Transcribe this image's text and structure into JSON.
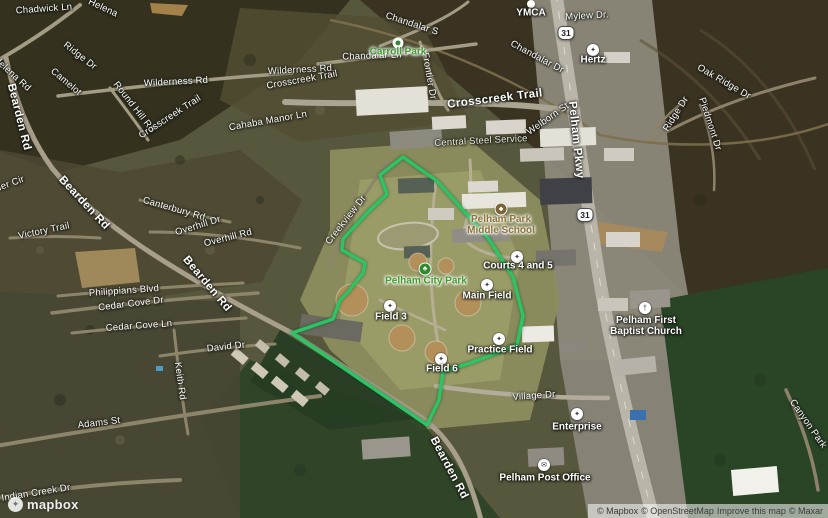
{
  "map": {
    "description": "3D satellite map of Pelham, Alabama with Pelham City Park boundary highlighted",
    "boundary": {
      "color": "#2BC565",
      "points": "403,157 437,181 488,238 513,277 523,316 517,345 473,362 443,372 439,400 427,425 292,333 333,319 340,300 348,292 363,273 365,263 342,250 343,239 368,212 387,194 380,175"
    }
  },
  "shields": [
    {
      "label": "31",
      "x": 566,
      "y": 33
    },
    {
      "label": "31",
      "x": 585,
      "y": 215
    }
  ],
  "road_labels": [
    {
      "t": "Chadwick Ln",
      "x": 44,
      "y": 9,
      "r": -4
    },
    {
      "t": "Helena",
      "x": 103,
      "y": 8,
      "r": 25
    },
    {
      "t": "Ridge Dr",
      "x": 80,
      "y": 56,
      "r": 38
    },
    {
      "t": "Helena Rd",
      "x": 12,
      "y": 74,
      "r": 42
    },
    {
      "t": "Camelot",
      "x": 66,
      "y": 82,
      "r": 40
    },
    {
      "t": "Bearden Rd",
      "x": 19,
      "y": 117,
      "r": 76,
      "big": true
    },
    {
      "t": "Wilderness Rd",
      "x": 176,
      "y": 82,
      "r": -3
    },
    {
      "t": "Wilderness Rd",
      "x": 300,
      "y": 70,
      "r": -3
    },
    {
      "t": "Round Hill Rd",
      "x": 134,
      "y": 107,
      "r": 52
    },
    {
      "t": "Crosscreek Trail",
      "x": 170,
      "y": 117,
      "r": -33
    },
    {
      "t": "Crosscreek Trail",
      "x": 302,
      "y": 80,
      "r": -10
    },
    {
      "t": "Cahaba Manor Ln",
      "x": 268,
      "y": 121,
      "r": -10
    },
    {
      "t": "Chandalar Ln",
      "x": 372,
      "y": 56,
      "r": -2
    },
    {
      "t": "Chandalar S",
      "x": 412,
      "y": 24,
      "r": 18
    },
    {
      "t": "Frontier Dr",
      "x": 429,
      "y": 76,
      "r": 80
    },
    {
      "t": "Crosscreek Trail",
      "x": 495,
      "y": 99,
      "r": -7,
      "big": true
    },
    {
      "t": "Welborn St",
      "x": 548,
      "y": 119,
      "r": -35
    },
    {
      "t": "Chandalar Dr",
      "x": 537,
      "y": 57,
      "r": 28
    },
    {
      "t": "Central Steel Service",
      "x": 481,
      "y": 141,
      "r": -3,
      "dim": true
    },
    {
      "t": "Mylew Dr.",
      "x": 587,
      "y": 16,
      "r": -3
    },
    {
      "t": "Oak Ridge Dr",
      "x": 724,
      "y": 82,
      "r": 30
    },
    {
      "t": "Ridge Dr",
      "x": 676,
      "y": 114,
      "r": -58
    },
    {
      "t": "Piedmont Dr",
      "x": 710,
      "y": 124,
      "r": 72
    },
    {
      "t": "Pelham Pkwy",
      "x": 576,
      "y": 140,
      "r": 84,
      "big": true
    },
    {
      "t": "Canterbury Rd",
      "x": 174,
      "y": 209,
      "r": 16
    },
    {
      "t": "Overhill Dr",
      "x": 198,
      "y": 226,
      "r": -17
    },
    {
      "t": "Overhill Rd",
      "x": 228,
      "y": 238,
      "r": -14
    },
    {
      "t": "Creekview Dr",
      "x": 346,
      "y": 220,
      "r": -52
    },
    {
      "t": "Victory Trail",
      "x": 44,
      "y": 231,
      "r": -12
    },
    {
      "t": "her Cir",
      "x": 10,
      "y": 184,
      "r": -20
    },
    {
      "t": "Bearden Rd",
      "x": 84,
      "y": 203,
      "r": 47,
      "big": true
    },
    {
      "t": "Bearden Rd",
      "x": 207,
      "y": 284,
      "r": 50,
      "big": true
    },
    {
      "t": "Bearden Rd",
      "x": 449,
      "y": 468,
      "r": 62,
      "big": true
    },
    {
      "t": "Philippians Blvd",
      "x": 124,
      "y": 291,
      "r": -4
    },
    {
      "t": "Cedar Cove Dr",
      "x": 131,
      "y": 304,
      "r": -7
    },
    {
      "t": "Cedar Cove Ln",
      "x": 139,
      "y": 326,
      "r": -4
    },
    {
      "t": "David Dr",
      "x": 226,
      "y": 347,
      "r": -6
    },
    {
      "t": "Keith Rd",
      "x": 180,
      "y": 381,
      "r": 82
    },
    {
      "t": "Adams St",
      "x": 99,
      "y": 423,
      "r": -7
    },
    {
      "t": "Indian Creek Dr",
      "x": 36,
      "y": 493,
      "r": -9
    },
    {
      "t": "Village Dr",
      "x": 534,
      "y": 396,
      "r": -4
    },
    {
      "t": "Canyon Park",
      "x": 808,
      "y": 424,
      "r": 55
    }
  ],
  "poi_labels": [
    {
      "text": "YMCA",
      "x": 531,
      "y": 14,
      "icon": "small",
      "icon_x": 531,
      "icon_y": 4
    },
    {
      "text": "Hertz",
      "x": 593,
      "y": 61,
      "icon": "circle",
      "glyph": "✦",
      "icon_x": 593,
      "icon_y": 50
    },
    {
      "text": "Carroll Park",
      "x": 398,
      "y": 53,
      "cls": "green",
      "icon": "parkdot",
      "icon_x": 398,
      "icon_y": 43
    },
    {
      "lines": [
        "Pelham Park",
        "Middle School"
      ],
      "x": 501,
      "y": 226,
      "cls": "school",
      "icon": "school",
      "glyph": "◆",
      "icon_x": 501,
      "icon_y": 209
    },
    {
      "text": "Courts 4 and 5",
      "x": 518,
      "y": 267,
      "icon": "circle",
      "glyph": "✦",
      "icon_x": 517,
      "icon_y": 257
    },
    {
      "text": "Pelham City Park",
      "x": 426,
      "y": 282,
      "cls": "green",
      "icon": "park",
      "glyph": "♣",
      "icon_x": 425,
      "icon_y": 269
    },
    {
      "text": "Main Field",
      "x": 487,
      "y": 297,
      "icon": "circle",
      "glyph": "✦",
      "icon_x": 487,
      "icon_y": 285
    },
    {
      "text": "Field 3",
      "x": 391,
      "y": 318,
      "icon": "circle",
      "glyph": "✦",
      "icon_x": 390,
      "icon_y": 306
    },
    {
      "text": "Field 6",
      "x": 442,
      "y": 370,
      "icon": "circle",
      "glyph": "✦",
      "icon_x": 441,
      "icon_y": 359
    },
    {
      "text": "Practice Field",
      "x": 500,
      "y": 351,
      "icon": "circle",
      "glyph": "✦",
      "icon_x": 499,
      "icon_y": 339
    },
    {
      "text": "Enterprise",
      "x": 577,
      "y": 428,
      "icon": "circle",
      "glyph": "✦",
      "icon_x": 577,
      "icon_y": 414
    },
    {
      "text": "Pelham Post Office",
      "x": 545,
      "y": 479,
      "icon": "circle",
      "glyph": "✉",
      "icon_x": 544,
      "icon_y": 465
    },
    {
      "lines": [
        "Pelham First",
        "Baptist Church"
      ],
      "x": 646,
      "y": 327,
      "icon": "circle",
      "glyph": "†",
      "icon_x": 645,
      "icon_y": 308
    }
  ],
  "logo": {
    "label": "mapbox"
  },
  "attribution": {
    "parts": [
      {
        "text": "© Mapbox",
        "link": true
      },
      {
        "text": "© OpenStreetMap",
        "link": true
      },
      {
        "text": "Improve this map",
        "link": true
      },
      {
        "text": "© Maxar",
        "link": true
      }
    ]
  }
}
